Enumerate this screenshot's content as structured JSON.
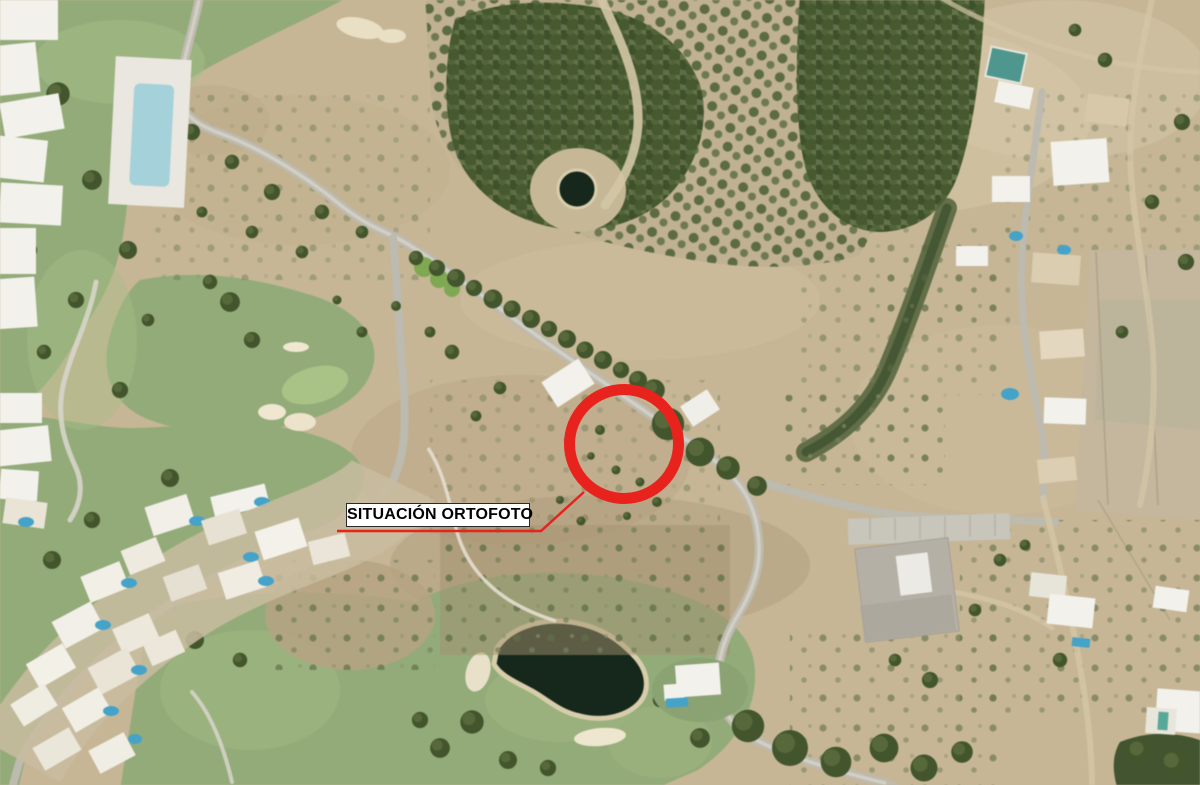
{
  "annotation": {
    "label": "SITUACIÓN ORTOFOTO"
  },
  "palette": {
    "annotation-red": "#e8221c",
    "label-bg": "#ffffff",
    "label-text": "#000000",
    "scrub-tan": "#c6b696",
    "golf-green": "#93ab79",
    "forest-green": "#46572e",
    "road-gray": "#bdbab0",
    "water-dark": "#16281c",
    "pool-blue": "#45a2c8",
    "reservoir-teal": "#4f968e",
    "building-white": "#f2f1ec"
  }
}
